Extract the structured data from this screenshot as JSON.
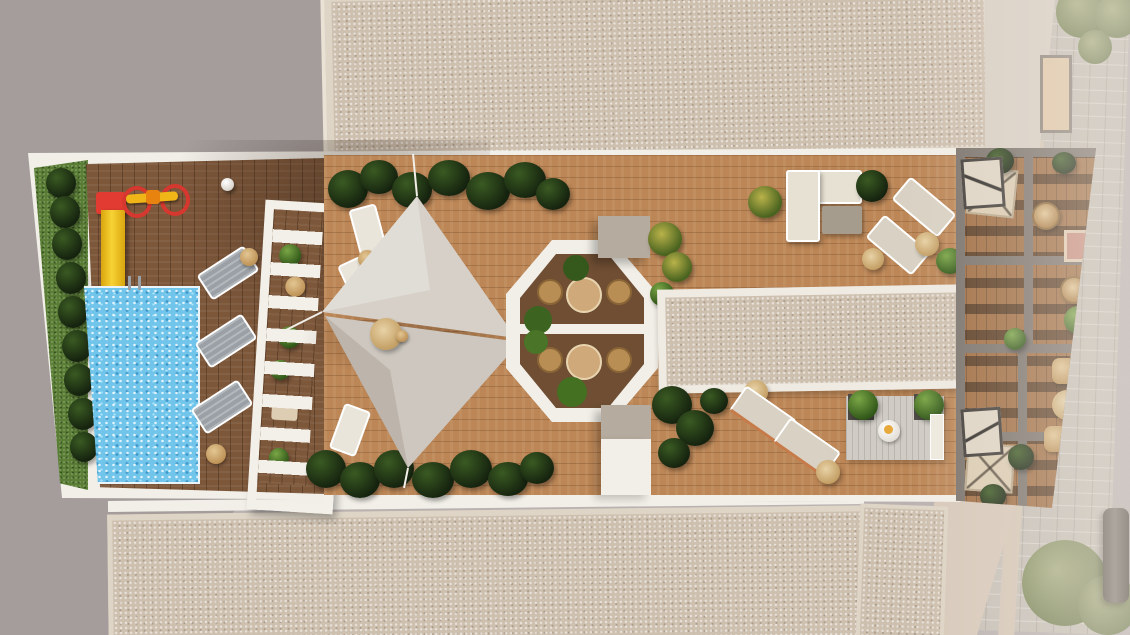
{
  "scene": {
    "type": "aerial-architectural-render",
    "description": "Top-down 3D render of a residential rooftop solarium terrace flanked by gravel roofs, a neighbouring flat roof and a cobblestone street",
    "areas": {
      "pool_zone": "Kids playground with red-and-yellow slide and carousel, rectangular swimming pool with ladder, grass strip with hedge, three grey sun loungers, white slatted pergola",
      "sail_zone": "Light wood deck with two triangular shade sails, round table, white sun loungers, dark planting clusters on both edges",
      "dining_octagon": "White octagonal planter frame with two round tables, rattan chairs and bushes, flanked by two taupe roof bulkheads",
      "lounge_zone": "Cream L-shaped sofa with coffee table, diagonal sun loungers with round side tables, long gravel skylight strip, outdoor rug seating set with planters",
      "private_terraces": "Four walled private roof terraces with wood decking, square parasols, hanging chairs, rattan furniture and shrubs",
      "surroundings": "Beige gravel roofs above and below, grey flat roof left, cobblestone street with parked car and trees right"
    },
    "counts": {
      "shade_sails": 2,
      "grey_loungers": 3,
      "white_loungers": 3,
      "cream_loungers": 4,
      "octagon_tables": 2,
      "octagon_chairs": 4,
      "private_terrace_parasols": 2
    },
    "labels": {
      "pool": "swimming-pool",
      "slide": "kids-slide",
      "carousel": "playground-carousel",
      "pergola": "white-pergola",
      "sails": "shade-sails",
      "octagon": "octagonal-dining-patio",
      "skylight": "gravel-skylight-strip",
      "sofa": "lounge-sofa",
      "rug_set": "outdoor-rug-lounge",
      "terraces": "private-terraces",
      "street": "cobblestone-street",
      "car": "parked-car",
      "tree": "street-tree"
    }
  },
  "palette": {
    "roof_grey": "#b9b2b1",
    "gravel": "#cec0af",
    "gravel_border": "#ded5c6",
    "wood_dark": "#7d573a",
    "wood_light": "#bc8656",
    "wood_private": "#a06d42",
    "white_frame": "#f2efe8",
    "pool_blue": "#72c5ea",
    "grass_green": "#5a7e35",
    "plant_dark": "#15230f",
    "plant_bright": "#2d5316",
    "sail_fabric": "#d4cec6",
    "bulkhead_taupe": "#b5ab9e",
    "slide_red": "#e23b31",
    "slide_yellow": "#f5c713",
    "lounger_grey": "#9aa0a5",
    "lounger_cream": "#d9d2c4",
    "rattan": "#c49b63",
    "street_cobble": "#c6c0b8",
    "wall_beige": "#d6c8b8"
  }
}
